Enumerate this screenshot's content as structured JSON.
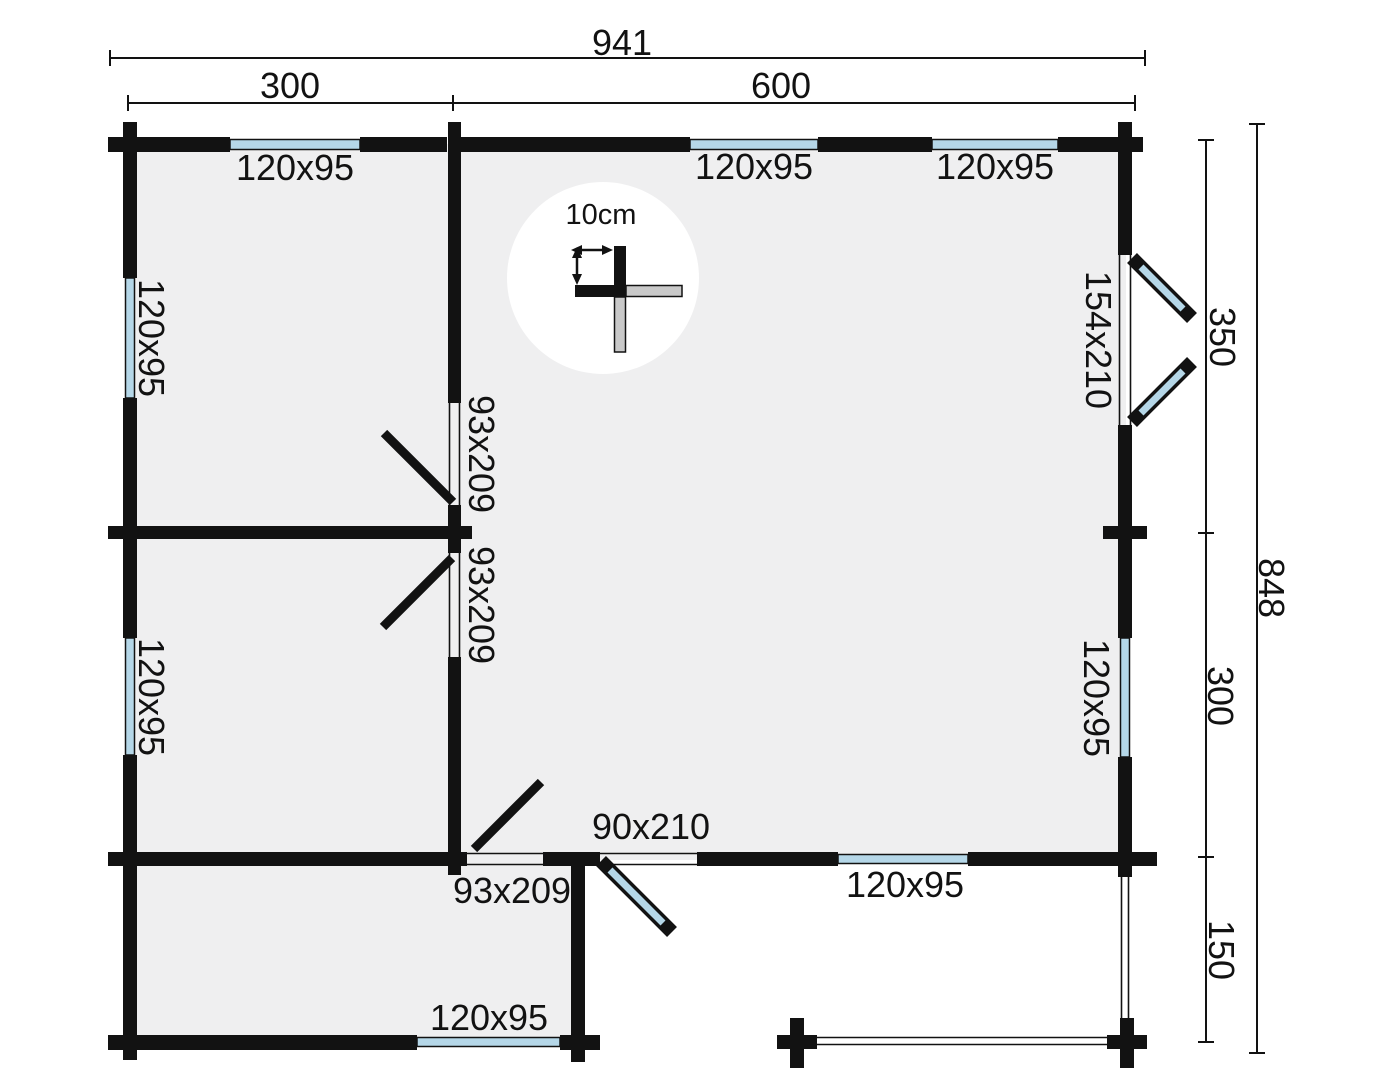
{
  "plan": {
    "scale_label": "10cm",
    "dimensions": {
      "total_width": "941",
      "left_width": "300",
      "right_width": "600",
      "total_height": "848",
      "right_top": "350",
      "right_middle": "300",
      "terrace_depth": "150"
    },
    "windows": {
      "top_left": "120x95",
      "top_middle": "120x95",
      "top_right": "120x95",
      "left_upper": "120x95",
      "left_lower": "120x95",
      "right_side": "120x95",
      "bottom_main": "120x95",
      "annex_bottom": "120x95"
    },
    "doors": {
      "double_door_right": "154x210",
      "interior_upper": "93x209",
      "interior_lower": "93x209",
      "annex_interior": "93x209",
      "back_door": "90x210"
    }
  }
}
